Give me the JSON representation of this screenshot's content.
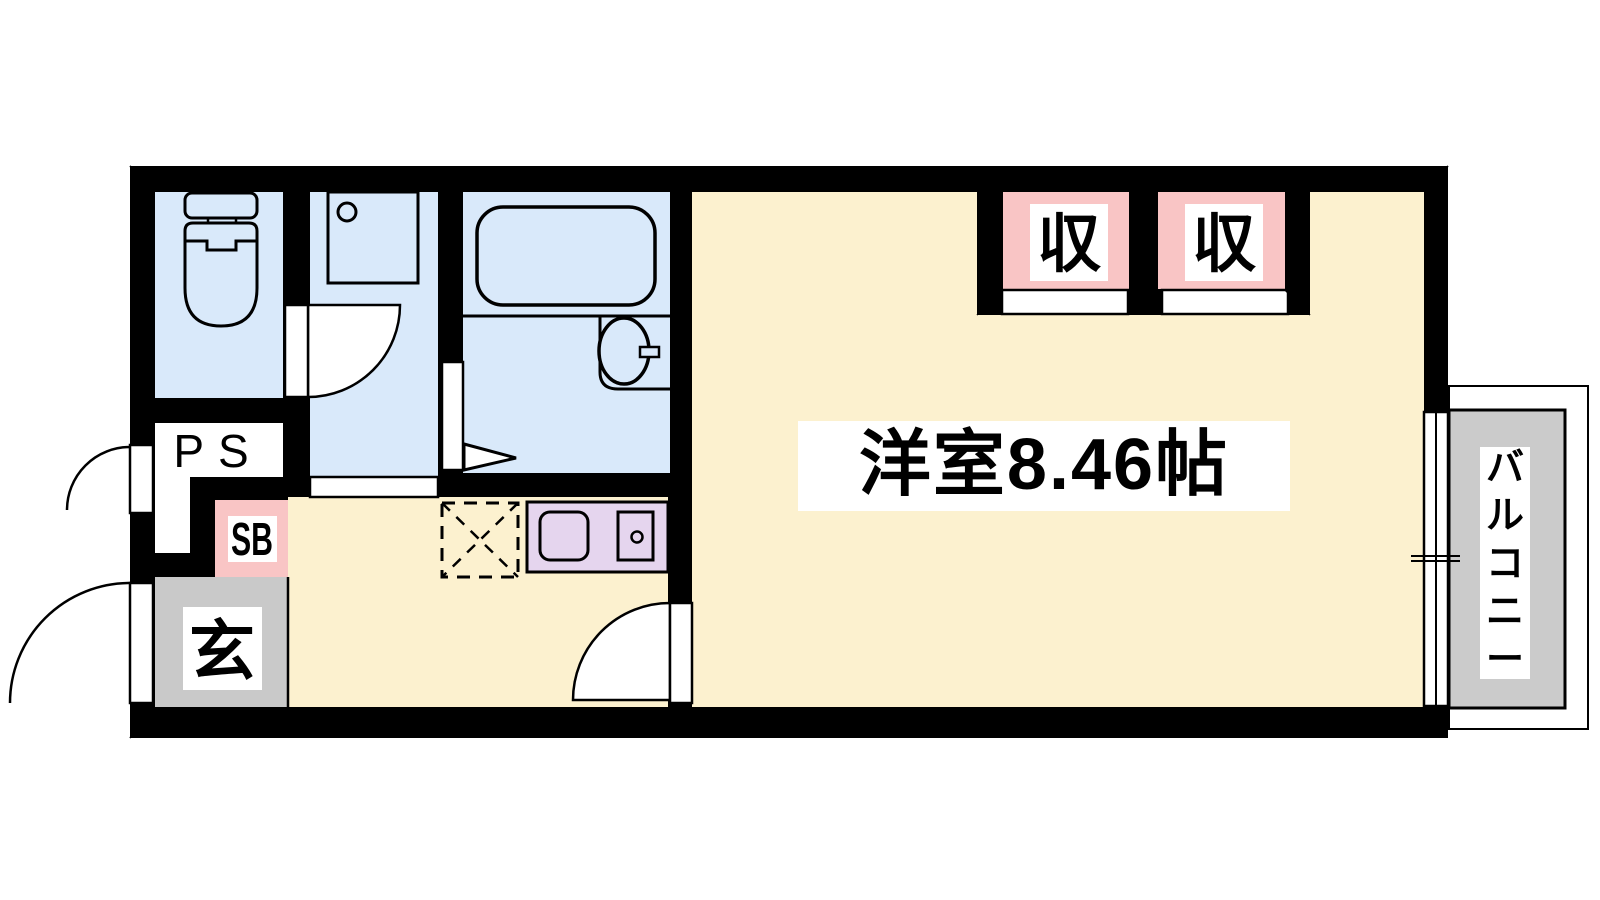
{
  "plan": {
    "title": "apartment floor plan",
    "main_room_label": "洋室8.46帖",
    "closet_label_1": "収",
    "closet_label_2": "収",
    "balcony_label": "バルコニー",
    "entrance_label": "玄",
    "shoe_box_label": "SB",
    "pipe_space_label": "PS"
  },
  "colors": {
    "wall": "#000000",
    "background": "#ffffff",
    "room_floor": "#fcf1cf",
    "wet_area": "#d9e9fa",
    "closet": "#f9c5c5",
    "kitchen_counter": "#e5d5ee",
    "entrance_floor": "#c9c9c9",
    "balcony_floor": "#cbcbcb",
    "label_box": "#ffffff"
  }
}
